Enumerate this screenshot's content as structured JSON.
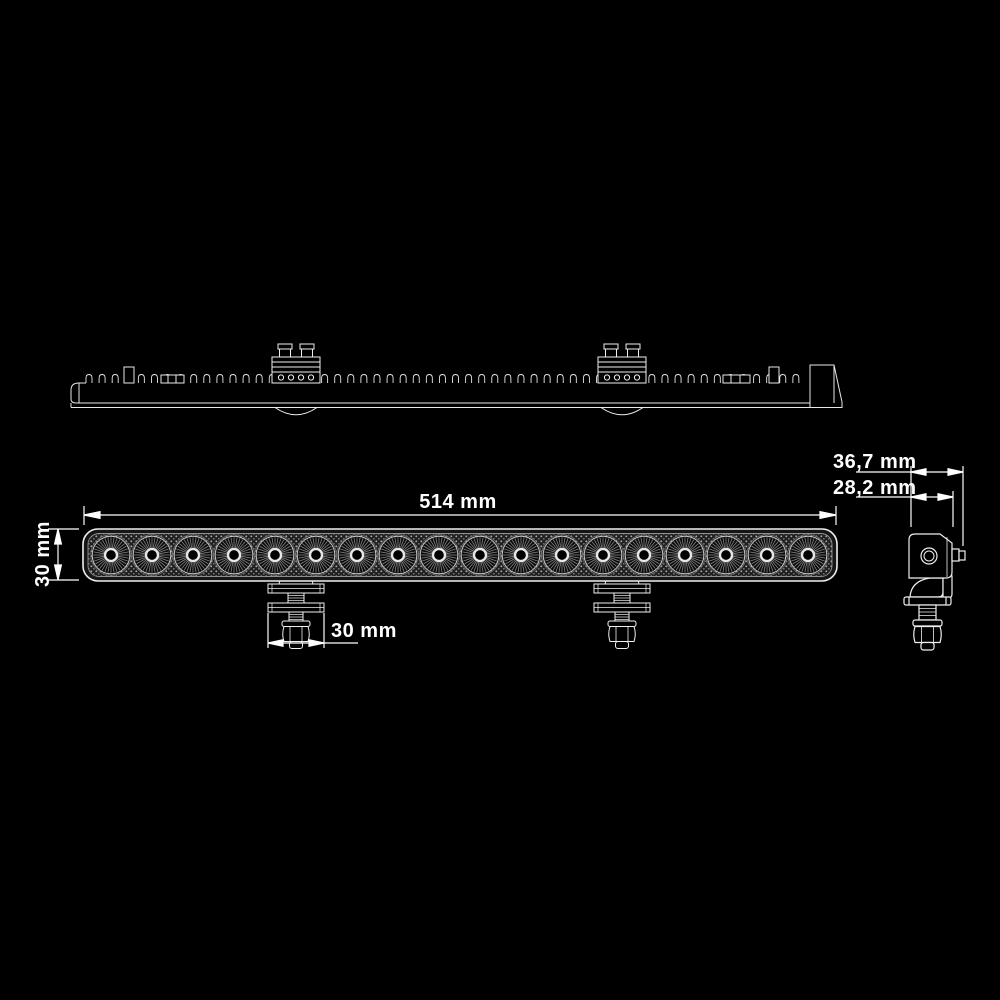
{
  "figure": {
    "kind": "technical-drawing",
    "subject": "LED light bar with mounting brackets, three orthographic views (top, front, side)",
    "background_color": "#000000",
    "line_color": "#ffffff"
  },
  "dimensions": {
    "length": {
      "label": "514 mm"
    },
    "height": {
      "label": "30 mm"
    },
    "bracket_width": {
      "label": "30 mm"
    },
    "depth_overall": {
      "label": "36,7 mm"
    },
    "depth_body": {
      "label": "28,2 mm"
    }
  },
  "drawing": {
    "led_count": 18,
    "fin_count": 55,
    "bracket_count": 2,
    "views": [
      "top",
      "front",
      "side"
    ]
  }
}
